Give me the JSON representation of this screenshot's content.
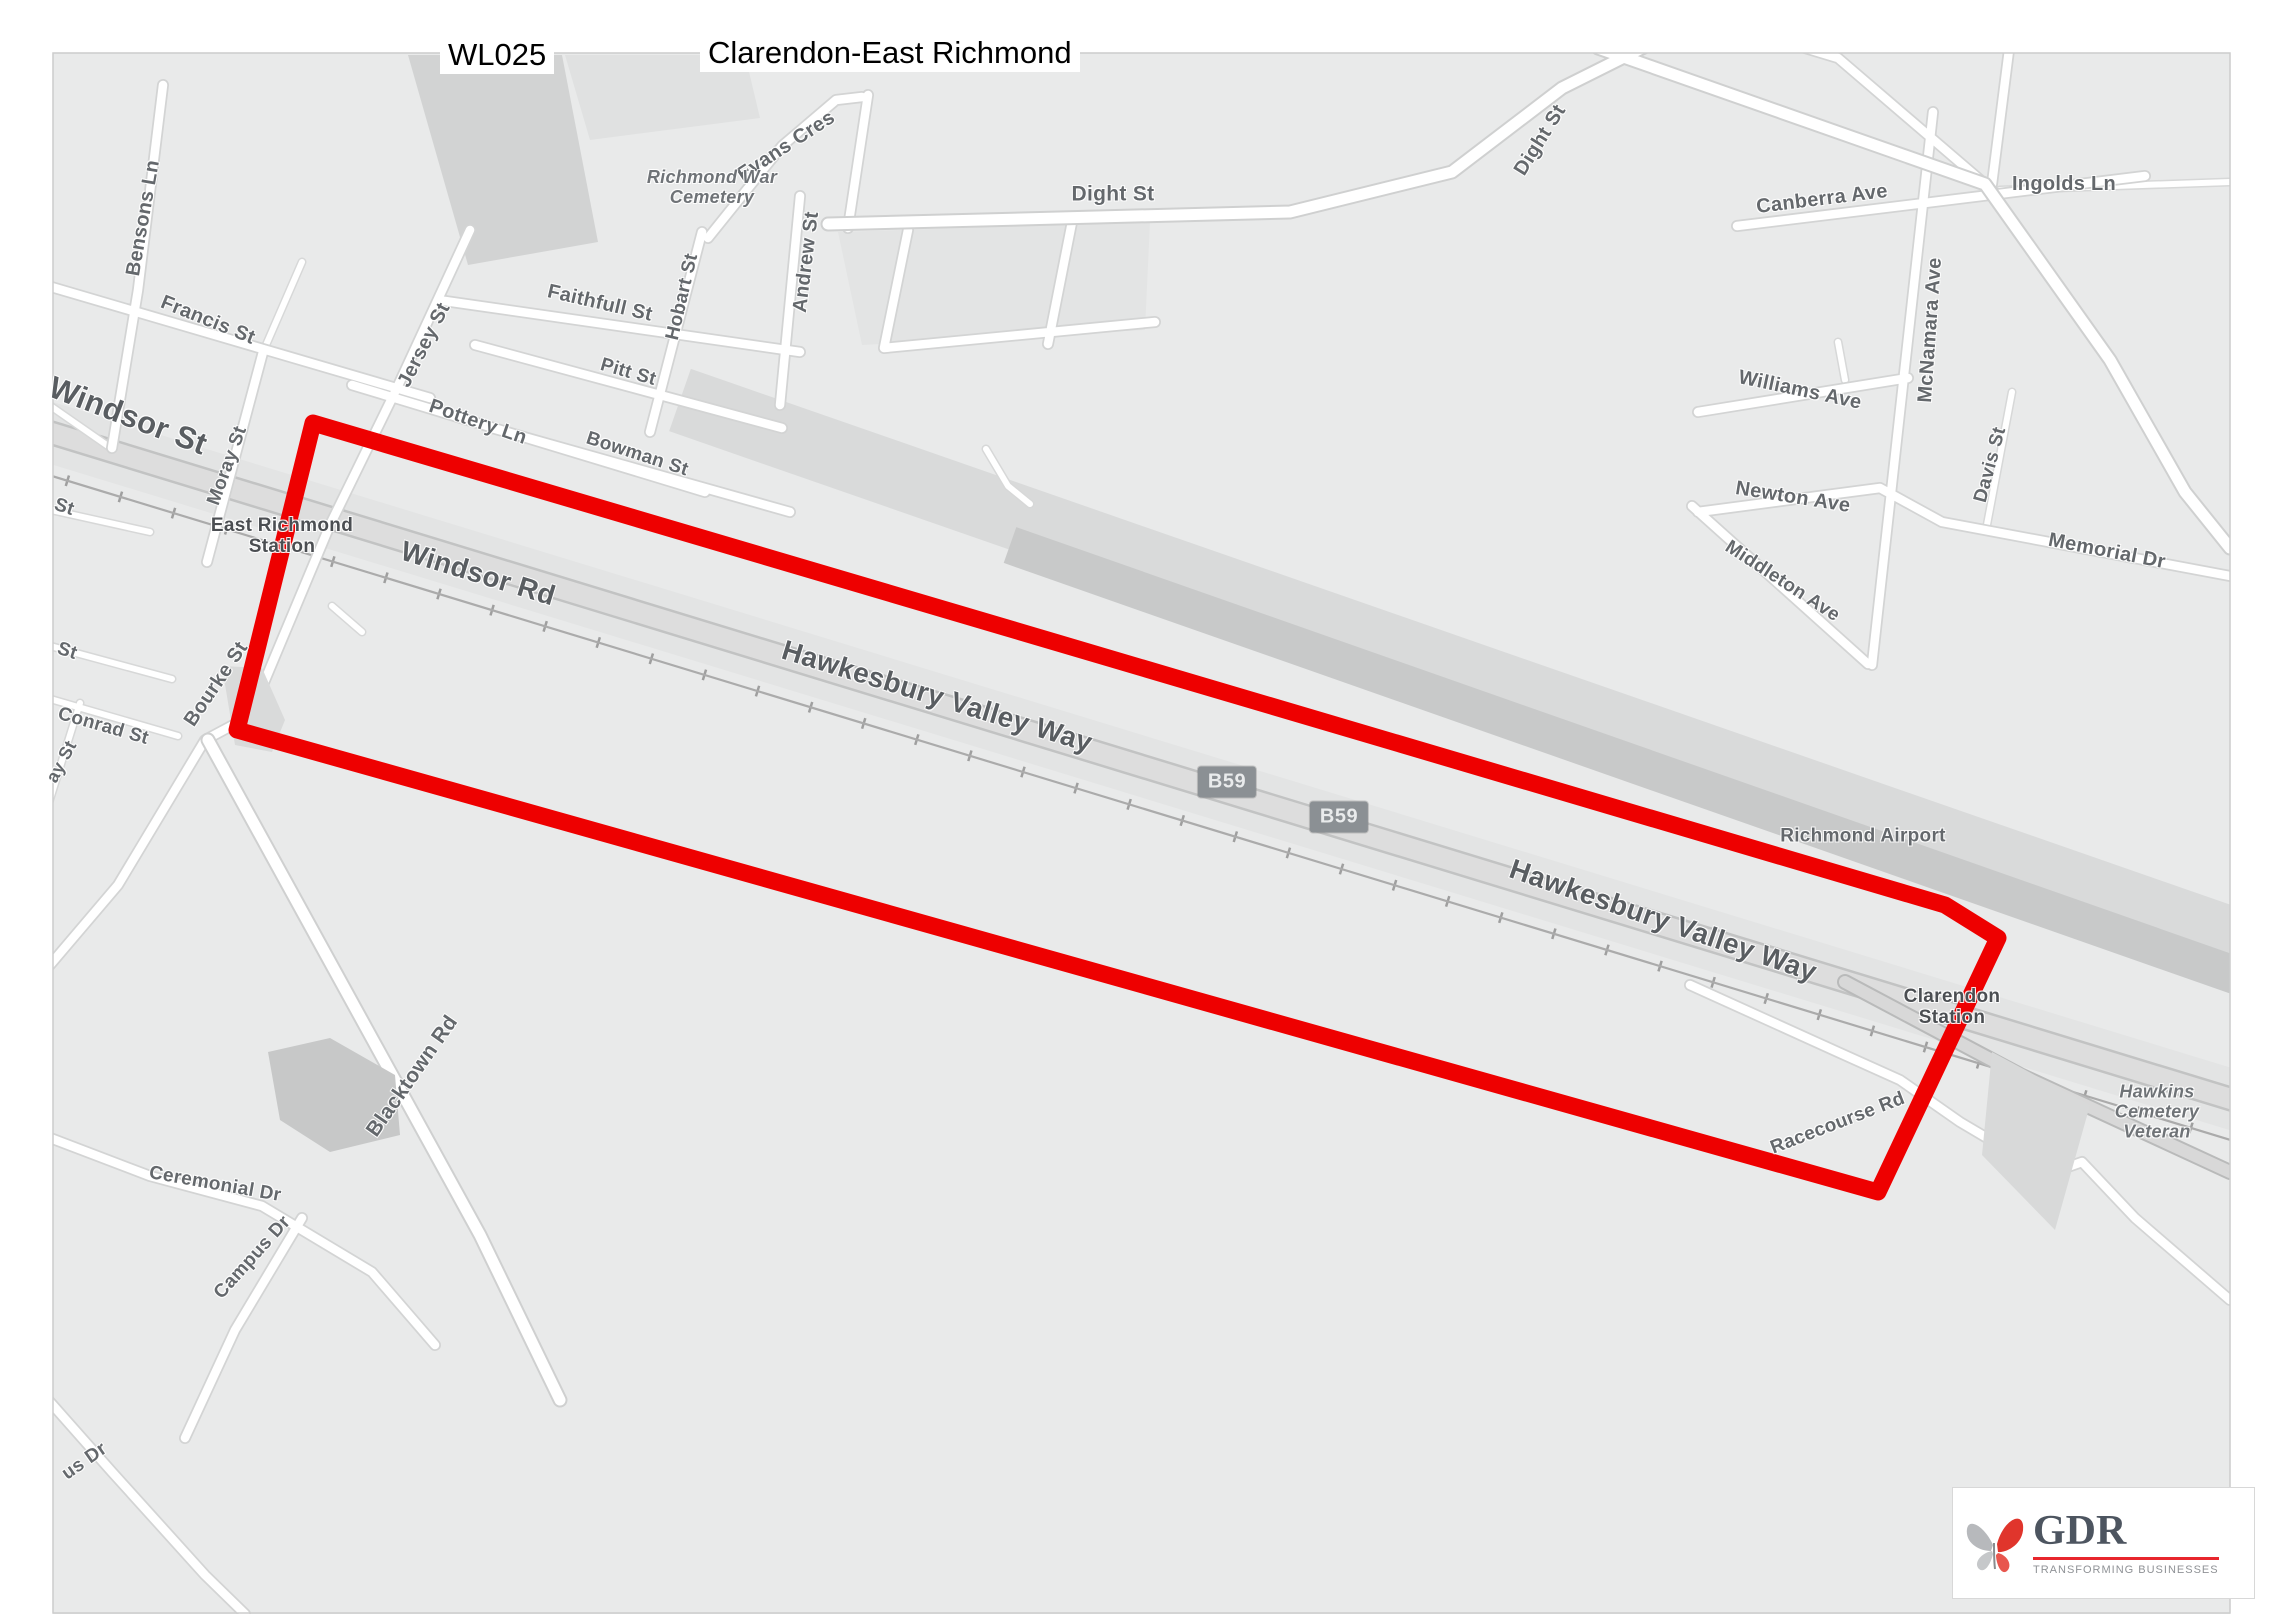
{
  "titles": {
    "code": "WL025",
    "name": "Clarendon-East Richmond"
  },
  "logo": {
    "name": "GDR",
    "tagline": "TRANSFORMING BUSINESSES"
  },
  "map": {
    "colors": {
      "background": "#e9eaea",
      "highlight_outline": "#ee0000",
      "road_fill": "#ffffff",
      "corridor_fill": "#dddddd",
      "badge_bg": "#8b9094",
      "label_gray": "#64686c"
    },
    "badges": [
      {
        "id": "route-badge-b59-1",
        "t": "B59",
        "x": 1227,
        "y": 782
      },
      {
        "id": "route-badge-b59-2",
        "t": "B59",
        "x": 1339,
        "y": 817
      }
    ],
    "labels": [
      {
        "id": "label-bensons-ln",
        "t": "Bensons Ln",
        "x": 143,
        "y": 218,
        "r": -80,
        "s": 20
      },
      {
        "id": "label-francis-st",
        "t": "Francis St",
        "x": 208,
        "y": 320,
        "r": 22,
        "s": 20
      },
      {
        "id": "label-windsor-st",
        "t": "Windsor St",
        "x": 128,
        "y": 416,
        "r": 21,
        "s": 31,
        "k": "k-big"
      },
      {
        "id": "label-moray-st",
        "t": "Moray St",
        "x": 228,
        "y": 466,
        "r": -70,
        "s": 19
      },
      {
        "id": "label-st-fragment-1",
        "t": "St",
        "x": 64,
        "y": 508,
        "r": 18,
        "s": 19
      },
      {
        "id": "label-east-richmond-station",
        "t": "East Richmond\nStation",
        "x": 282,
        "y": 537,
        "r": 0,
        "s": 19,
        "k": "k-dark"
      },
      {
        "id": "label-st-fragment-2",
        "t": "St",
        "x": 67,
        "y": 652,
        "r": 18,
        "s": 19
      },
      {
        "id": "label-conrad-st",
        "t": "Conrad St",
        "x": 103,
        "y": 727,
        "r": 16,
        "s": 19
      },
      {
        "id": "label-ay-st-fragment",
        "t": "ay St",
        "x": 62,
        "y": 762,
        "r": -62,
        "s": 18
      },
      {
        "id": "label-bourke-st",
        "t": "Bourke St",
        "x": 216,
        "y": 684,
        "r": -56,
        "s": 20
      },
      {
        "id": "label-jersey-st",
        "t": "Jersey St",
        "x": 424,
        "y": 345,
        "r": -63,
        "s": 20
      },
      {
        "id": "label-pottery-ln",
        "t": "Pottery Ln",
        "x": 478,
        "y": 422,
        "r": 19,
        "s": 20
      },
      {
        "id": "label-bowman-st",
        "t": "Bowman St",
        "x": 637,
        "y": 455,
        "r": 18,
        "s": 19
      },
      {
        "id": "label-pitt-st",
        "t": "Pitt St",
        "x": 628,
        "y": 373,
        "r": 16,
        "s": 19
      },
      {
        "id": "label-faithfull-st",
        "t": "Faithfull St",
        "x": 600,
        "y": 303,
        "r": 13,
        "s": 20
      },
      {
        "id": "label-hobart-st",
        "t": "Hobart St",
        "x": 683,
        "y": 297,
        "r": -77,
        "s": 19
      },
      {
        "id": "label-andrew-st",
        "t": "Andrew St",
        "x": 806,
        "y": 262,
        "r": -83,
        "s": 20
      },
      {
        "id": "label-evans-cres",
        "t": "Evans Cres",
        "x": 786,
        "y": 146,
        "r": -33,
        "s": 20
      },
      {
        "id": "label-dight-st-west",
        "t": "Dight St",
        "x": 1113,
        "y": 194,
        "r": 0,
        "s": 21
      },
      {
        "id": "label-richmond-war-cemetery",
        "t": "Richmond War\nCemetery",
        "x": 712,
        "y": 188,
        "r": 0,
        "s": 18,
        "k": "k-italic"
      },
      {
        "id": "label-dight-st-east",
        "t": "Dight St",
        "x": 1540,
        "y": 140,
        "r": -58,
        "s": 20
      },
      {
        "id": "label-canberra-ave",
        "t": "Canberra Ave",
        "x": 1822,
        "y": 199,
        "r": -7,
        "s": 20
      },
      {
        "id": "label-ingolds-ln",
        "t": "Ingolds Ln",
        "x": 2064,
        "y": 184,
        "r": 0,
        "s": 20
      },
      {
        "id": "label-mcnamara-ave",
        "t": "McNamara Ave",
        "x": 1930,
        "y": 330,
        "r": -86,
        "s": 20
      },
      {
        "id": "label-williams-ave",
        "t": "Williams Ave",
        "x": 1800,
        "y": 390,
        "r": 12,
        "s": 20
      },
      {
        "id": "label-newton-ave",
        "t": "Newton Ave",
        "x": 1793,
        "y": 497,
        "r": 9,
        "s": 20
      },
      {
        "id": "label-davis-st",
        "t": "Davis St",
        "x": 1991,
        "y": 465,
        "r": -75,
        "s": 19
      },
      {
        "id": "label-memorial-dr",
        "t": "Memorial Dr",
        "x": 2107,
        "y": 551,
        "r": 11,
        "s": 20
      },
      {
        "id": "label-middleton-ave",
        "t": "Middleton Ave",
        "x": 1782,
        "y": 582,
        "r": 33,
        "s": 19
      },
      {
        "id": "label-windsor-rd",
        "t": "Windsor Rd",
        "x": 478,
        "y": 574,
        "r": 17,
        "s": 28,
        "k": "k-big"
      },
      {
        "id": "label-hawkesbury-valley-way-west",
        "t": "Hawkesbury Valley Way",
        "x": 937,
        "y": 697,
        "r": 17,
        "s": 28,
        "k": "k-big"
      },
      {
        "id": "label-hawkesbury-valley-way-east",
        "t": "Hawkesbury Valley Way",
        "x": 1663,
        "y": 921,
        "r": 19,
        "s": 28,
        "k": "k-big"
      },
      {
        "id": "label-richmond-airport",
        "t": "Richmond Airport",
        "x": 1863,
        "y": 837,
        "r": 0,
        "s": 19
      },
      {
        "id": "label-clarendon-station",
        "t": "Clarendon\nStation",
        "x": 1952,
        "y": 1008,
        "r": 0,
        "s": 19,
        "k": "k-dark"
      },
      {
        "id": "label-racecourse-rd",
        "t": "Racecourse Rd",
        "x": 1838,
        "y": 1124,
        "r": -21,
        "s": 19
      },
      {
        "id": "label-hawkins-cemetery-veteran",
        "t": "Hawkins\nCemetery\nVeteran",
        "x": 2157,
        "y": 1112,
        "r": 0,
        "s": 18,
        "k": "k-italic"
      },
      {
        "id": "label-blacktown-rd",
        "t": "Blacktown Rd",
        "x": 412,
        "y": 1076,
        "r": -55,
        "s": 21
      },
      {
        "id": "label-ceremonial-dr",
        "t": "Ceremonial Dr",
        "x": 215,
        "y": 1185,
        "r": 10,
        "s": 19
      },
      {
        "id": "label-campus-dr",
        "t": "Campus Dr",
        "x": 253,
        "y": 1258,
        "r": -48,
        "s": 19
      },
      {
        "id": "label-us-dr-fragment",
        "t": "us Dr",
        "x": 85,
        "y": 1462,
        "r": -35,
        "s": 19
      }
    ]
  }
}
